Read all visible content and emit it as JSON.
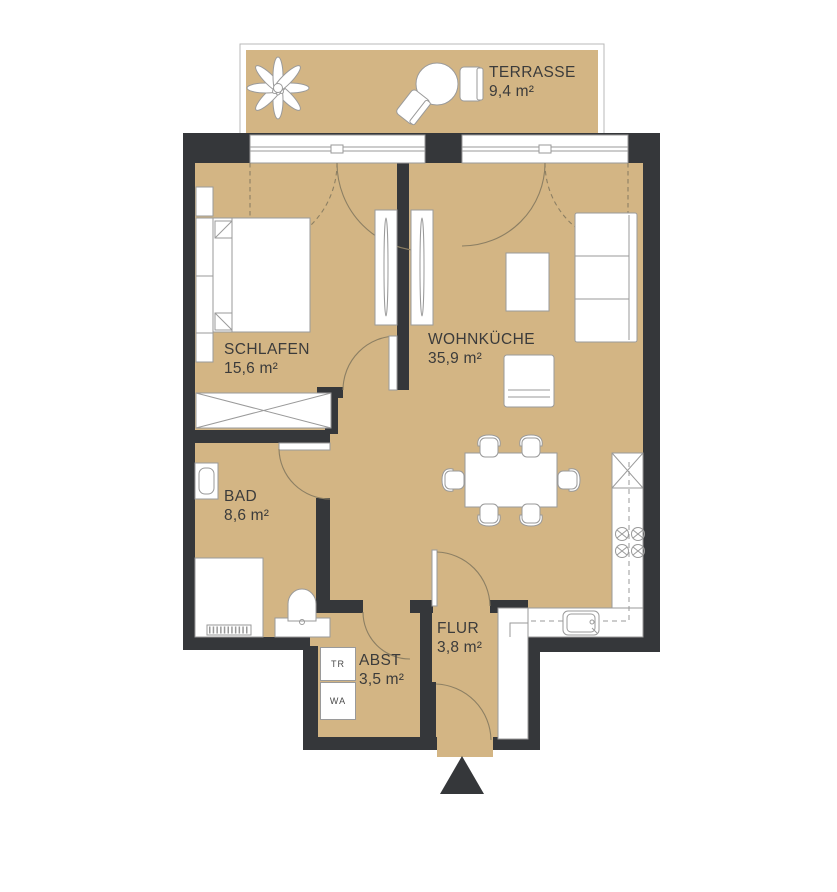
{
  "colors": {
    "bg": "#ffffff",
    "floor": "#d3b584",
    "wall": "#35373a",
    "furniture-stroke": "#9a9a9a",
    "door-stroke": "#8c7f63",
    "label": "#3b3b3b"
  },
  "rooms": {
    "terrasse": {
      "name": "TERRASSE",
      "area": "9,4 m²"
    },
    "schlafen": {
      "name": "SCHLAFEN",
      "area": "15,6 m²"
    },
    "wohnkueche": {
      "name": "WOHNKÜCHE",
      "area": "35,9 m²"
    },
    "bad": {
      "name": "BAD",
      "area": "8,6 m²"
    },
    "abst": {
      "name": "ABST",
      "area": "3,5 m²"
    },
    "flur": {
      "name": "FLUR",
      "area": "3,8 m²"
    }
  },
  "appliances": {
    "dryer": "TR",
    "washer": "WA"
  }
}
